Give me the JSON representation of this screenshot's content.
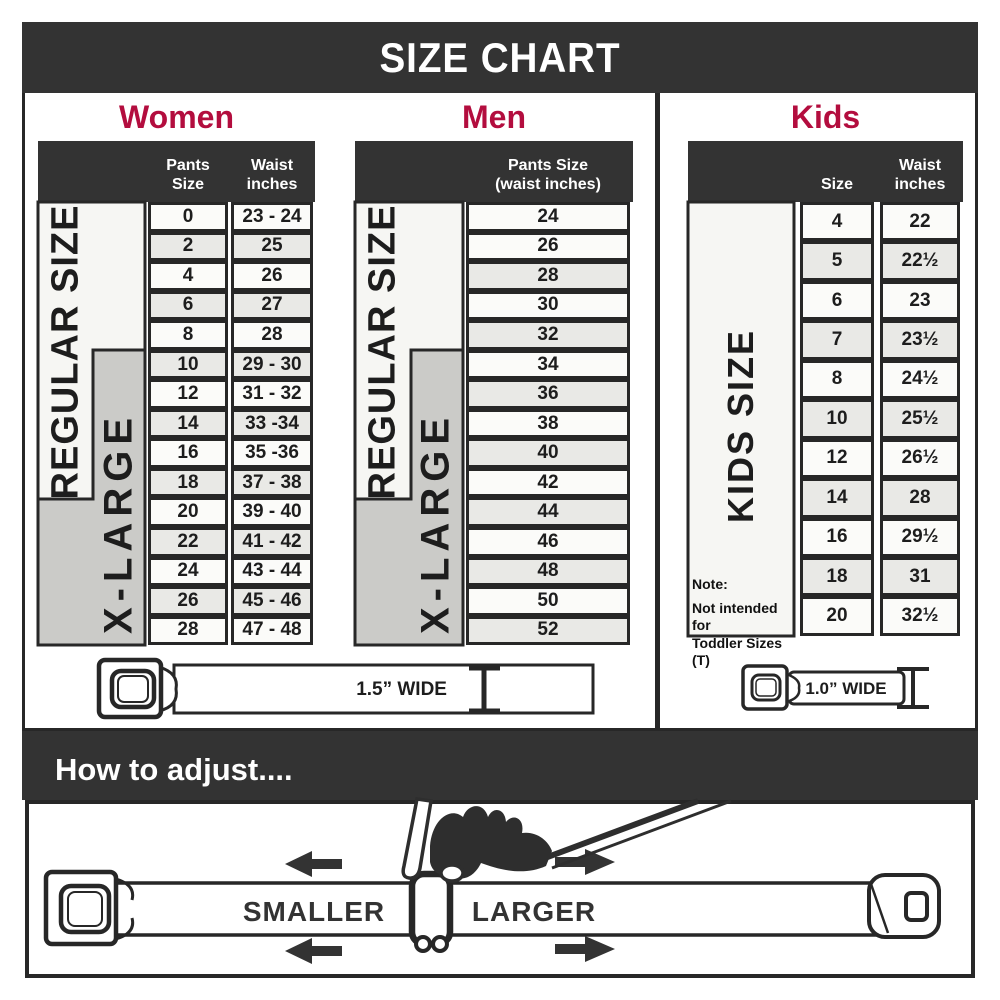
{
  "title": "SIZE CHART",
  "colors": {
    "accent": "#B30D3E",
    "band": "#333333",
    "alt_row": "#E9E9E6",
    "xlarge_box": "#CBCBC8"
  },
  "women": {
    "heading": "Women",
    "col_pants": "Pants Size",
    "col_waist_1": "Waist",
    "col_waist_2": "inches",
    "regular_label": "REGULAR SIZE",
    "xlarge_label": "X-LARGE",
    "rows": [
      {
        "size": "0",
        "waist": "23 - 24"
      },
      {
        "size": "2",
        "waist": "25"
      },
      {
        "size": "4",
        "waist": "26"
      },
      {
        "size": "6",
        "waist": "27"
      },
      {
        "size": "8",
        "waist": "28"
      },
      {
        "size": "10",
        "waist": "29 - 30"
      },
      {
        "size": "12",
        "waist": "31 - 32"
      },
      {
        "size": "14",
        "waist": "33 -34"
      },
      {
        "size": "16",
        "waist": "35 -36"
      },
      {
        "size": "18",
        "waist": "37 - 38"
      },
      {
        "size": "20",
        "waist": "39 - 40"
      },
      {
        "size": "22",
        "waist": "41 - 42"
      },
      {
        "size": "24",
        "waist": "43 - 44"
      },
      {
        "size": "26",
        "waist": "45 - 46"
      },
      {
        "size": "28",
        "waist": "47 - 48"
      }
    ]
  },
  "men": {
    "heading": "Men",
    "col_line1": "Pants Size",
    "col_line2": "(waist inches)",
    "regular_label": "REGULAR SIZE",
    "xlarge_label": "X-LARGE",
    "rows": [
      "24",
      "26",
      "28",
      "30",
      "32",
      "34",
      "36",
      "38",
      "40",
      "42",
      "44",
      "46",
      "48",
      "50",
      "52"
    ]
  },
  "kids": {
    "heading": "Kids",
    "col_size": "Size",
    "col_waist_1": "Waist",
    "col_waist_2": "inches",
    "side_label": "KIDS SIZE",
    "note": [
      "Note:",
      "Not intended for",
      "Toddler Sizes (T)"
    ],
    "rows": [
      {
        "size": "4",
        "waist": "22"
      },
      {
        "size": "5",
        "waist": "22½"
      },
      {
        "size": "6",
        "waist": "23"
      },
      {
        "size": "7",
        "waist": "23½"
      },
      {
        "size": "8",
        "waist": "24½"
      },
      {
        "size": "10",
        "waist": "25½"
      },
      {
        "size": "12",
        "waist": "26½"
      },
      {
        "size": "14",
        "waist": "28"
      },
      {
        "size": "16",
        "waist": "29½"
      },
      {
        "size": "18",
        "waist": "31"
      },
      {
        "size": "20",
        "waist": "32½"
      }
    ]
  },
  "belts": {
    "adult_width_label": "1.5” WIDE",
    "kids_width_label": "1.0” WIDE"
  },
  "adjust": {
    "heading": "How to adjust....",
    "smaller": "SMALLER",
    "larger": "LARGER"
  }
}
